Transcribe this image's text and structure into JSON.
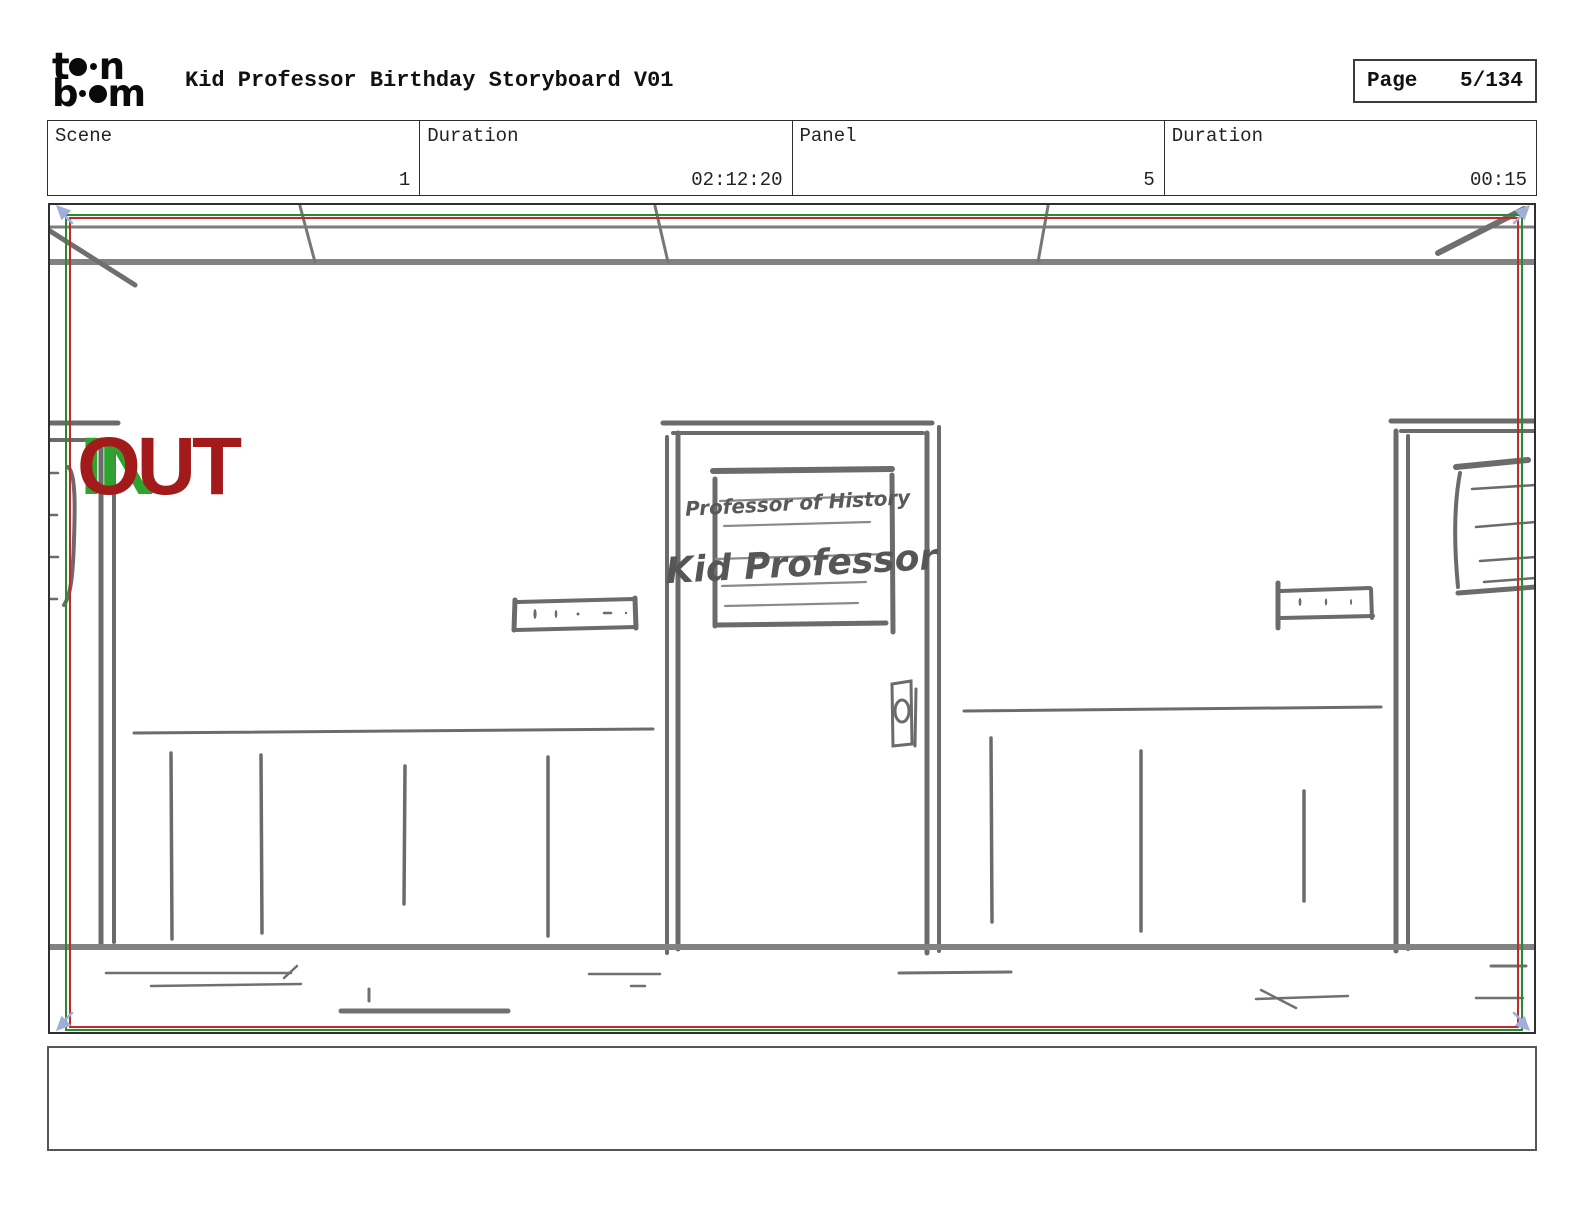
{
  "header": {
    "logo": {
      "name": "toon-boom-logo",
      "row1_left": "t",
      "row1_right": "n",
      "row2_left": "b",
      "row2_right": "m"
    },
    "title": "Kid Professor Birthday Storyboard V01",
    "page_label": "Page",
    "page_value": "5/134"
  },
  "info_bar": {
    "cells": [
      {
        "label": "Scene",
        "value": "1"
      },
      {
        "label": "Duration",
        "value": "02:12:20"
      },
      {
        "label": "Panel",
        "value": "5"
      },
      {
        "label": "Duration",
        "value": "00:15"
      }
    ]
  },
  "panel": {
    "camera_in_label": "IN",
    "camera_out_label": "OUT",
    "door_sign": {
      "line1": "Professor of History",
      "line2": "Kid Professor"
    },
    "caption_text": ""
  },
  "colors": {
    "camera_in_green": "#2ea42e",
    "camera_out_red": "#a21a1a",
    "frame_green": "#2b8a2b",
    "frame_red": "#c22a2a",
    "corner_marker_blue": "#9faedc",
    "sketch_gray": "#6b6b6b"
  }
}
